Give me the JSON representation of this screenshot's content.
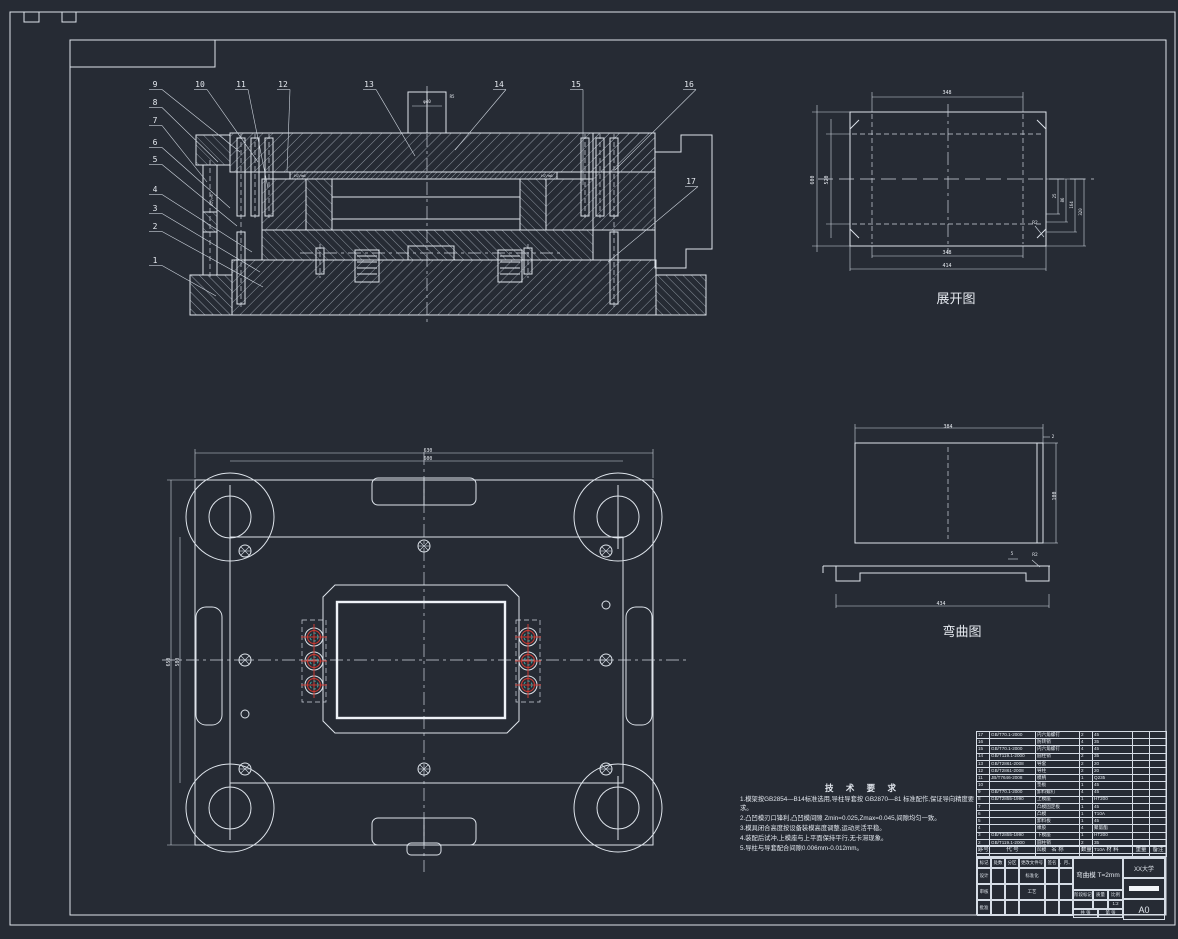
{
  "colors": {
    "bg": "#262b34",
    "line": "#dde3ea",
    "red": "#cc3a32",
    "teal": "#3f9f9f"
  },
  "views": {
    "develop": {
      "title": "展开图",
      "dims": [
        {
          "t": "348",
          "x": 947,
          "y": 94,
          "s": 5
        },
        {
          "t": "600",
          "x": 814,
          "y": 180,
          "r": -90,
          "s": 5
        },
        {
          "t": "520",
          "x": 828,
          "y": 180,
          "r": -90,
          "s": 5
        },
        {
          "t": "348",
          "x": 947,
          "y": 254,
          "s": 5
        },
        {
          "t": "414",
          "x": 947,
          "y": 267,
          "s": 5
        },
        {
          "t": "25",
          "x": 1056,
          "y": 196,
          "r": -90,
          "s": 4
        },
        {
          "t": "86",
          "x": 1064,
          "y": 200,
          "r": -90,
          "s": 4
        },
        {
          "t": "164",
          "x": 1073,
          "y": 205,
          "r": -90,
          "s": 4
        },
        {
          "t": "320",
          "x": 1082,
          "y": 212,
          "r": -90,
          "s": 4
        },
        {
          "t": "R2",
          "x": 1035,
          "y": 224,
          "s": 4.5
        }
      ]
    },
    "bend": {
      "title": "弯曲图",
      "dims": [
        {
          "t": "384",
          "x": 948,
          "y": 428,
          "s": 5
        },
        {
          "t": "2",
          "x": 1053,
          "y": 438,
          "s": 4.5
        },
        {
          "t": "100",
          "x": 1056,
          "y": 496,
          "r": -90,
          "s": 5
        },
        {
          "t": "R2",
          "x": 1035,
          "y": 556,
          "s": 4.5
        },
        {
          "t": "5",
          "x": 1012,
          "y": 555,
          "s": 4.5
        },
        {
          "t": "434",
          "x": 941,
          "y": 605,
          "s": 5
        }
      ]
    },
    "plan": {
      "dims": [
        {
          "t": "630",
          "x": 428,
          "y": 452,
          "s": 4.8
        },
        {
          "t": "600",
          "x": 428,
          "y": 460,
          "s": 4.8
        },
        {
          "t": "650",
          "x": 170,
          "y": 662,
          "r": -90,
          "s": 4.8
        },
        {
          "t": "580",
          "x": 179,
          "y": 662,
          "r": -90,
          "s": 4.8
        }
      ]
    },
    "section": {
      "labels": [
        {
          "t": "φ40",
          "x": 427,
          "y": 103,
          "s": 4.2
        },
        {
          "t": "R5",
          "x": 452,
          "y": 98,
          "s": 4
        },
        {
          "t": "H7/m6",
          "x": 300,
          "y": 177,
          "s": 3.8
        },
        {
          "t": "H7/m6",
          "x": 547,
          "y": 177,
          "s": 3.8
        },
        {
          "t": "H7/r6",
          "x": 213,
          "y": 200,
          "r": -90,
          "s": 3.8
        }
      ],
      "callouts": [
        {
          "n": "9",
          "x": 155,
          "y": 87,
          "tx": 240,
          "ty": 152
        },
        {
          "n": "8",
          "x": 155,
          "y": 105,
          "tx": 218,
          "ty": 162
        },
        {
          "n": "7",
          "x": 155,
          "y": 123,
          "tx": 207,
          "ty": 182
        },
        {
          "n": "6",
          "x": 155,
          "y": 145,
          "tx": 230,
          "ty": 208
        },
        {
          "n": "5",
          "x": 155,
          "y": 162,
          "tx": 237,
          "ty": 226
        },
        {
          "n": "4",
          "x": 155,
          "y": 192,
          "tx": 252,
          "ty": 252
        },
        {
          "n": "3",
          "x": 155,
          "y": 211,
          "tx": 260,
          "ty": 272
        },
        {
          "n": "2",
          "x": 155,
          "y": 229,
          "tx": 263,
          "ty": 287
        },
        {
          "n": "1",
          "x": 155,
          "y": 263,
          "tx": 216,
          "ty": 296
        },
        {
          "n": "10",
          "x": 200,
          "y": 87,
          "tx": 258,
          "ty": 162
        },
        {
          "n": "11",
          "x": 241,
          "y": 87,
          "tx": 268,
          "ty": 188
        },
        {
          "n": "12",
          "x": 283,
          "y": 87,
          "tx": 287,
          "ty": 172
        },
        {
          "n": "13",
          "x": 369,
          "y": 87,
          "tx": 415,
          "ty": 156
        },
        {
          "n": "14",
          "x": 499,
          "y": 87,
          "tx": 455,
          "ty": 150
        },
        {
          "n": "15",
          "x": 576,
          "y": 87,
          "tx": 583,
          "ty": 185
        },
        {
          "n": "16",
          "x": 689,
          "y": 87,
          "tx": 615,
          "ty": 170
        },
        {
          "n": "17",
          "x": 691,
          "y": 184,
          "tx": 608,
          "ty": 262
        }
      ]
    }
  },
  "notes": {
    "title": "技 术 要 求",
    "lines": [
      "1.模架按GB2854—B14标准选用,导柱导套按 GB2870—81 标准配作,保证导向精度要求。",
      "2.凸凹模刃口锋利,凸凹模间隙 Zmin=0.025,Zmax=0.045,间隙均匀一致。",
      "3.模具闭合高度按设备装模高度调整,运动灵活平稳。",
      "4.装配后试冲,上模座与上平面保持平行,无卡滞现象。",
      "5.导柱与导套配合间隙0.006mm-0.012mm。"
    ]
  },
  "bom": {
    "col_widths": [
      13,
      46,
      44,
      13,
      40,
      17,
      17
    ],
    "headers": [
      "序号",
      "代 号",
      "名 称",
      "数量",
      "材 料",
      "重量",
      "备注"
    ],
    "rows": [
      [
        "17",
        "GB/T70.1-2000",
        "内六角螺钉",
        "2",
        "45",
        "",
        ""
      ],
      [
        "16",
        "",
        "防转销",
        "4",
        "35",
        "",
        ""
      ],
      [
        "15",
        "GB/T70.1-2000",
        "内六角螺钉",
        "4",
        "45",
        "",
        ""
      ],
      [
        "14",
        "GB/T119.1-2000",
        "圆柱销",
        "2",
        "35",
        "",
        ""
      ],
      [
        "13",
        "GB/T2861-2008",
        "导套",
        "2",
        "20",
        "",
        ""
      ],
      [
        "12",
        "GB/T2861-2008",
        "导柱",
        "2",
        "20",
        "",
        ""
      ],
      [
        "11",
        "JB/T7646-2008",
        "模柄",
        "1",
        "Q235",
        "",
        ""
      ],
      [
        "10",
        "",
        "垫板",
        "1",
        "45",
        "",
        ""
      ],
      [
        "9",
        "GB/T70.1-2000",
        "卸料螺钉",
        "4",
        "45",
        "",
        ""
      ],
      [
        "8",
        "GB/T2855-1990",
        "上模座",
        "1",
        "HT200",
        "",
        ""
      ],
      [
        "7",
        "",
        "凸模固定板",
        "1",
        "45",
        "",
        ""
      ],
      [
        "6",
        "",
        "凸模",
        "1",
        "T10A",
        "",
        ""
      ],
      [
        "5",
        "",
        "卸料板",
        "1",
        "45",
        "",
        ""
      ],
      [
        "4",
        "",
        "橡胶",
        "4",
        "聚氨酯",
        "",
        ""
      ],
      [
        "3",
        "GB/T2855-1990",
        "下模座",
        "1",
        "HT200",
        "",
        ""
      ],
      [
        "2",
        "GB/T119.1-2000",
        "圆柱销",
        "2",
        "35",
        "",
        ""
      ],
      [
        "1",
        "",
        "凹模",
        "1",
        "T10A",
        "",
        ""
      ]
    ]
  },
  "titleblock": {
    "rev_table": {
      "widths": [
        14,
        14,
        14,
        26,
        14,
        14
      ],
      "heights": [
        10,
        16,
        16,
        16
      ],
      "rows": [
        [
          "标记",
          "处数",
          "分区",
          "更改文件号",
          "签名",
          "年、月、日"
        ],
        [
          "设计",
          "",
          "",
          "标准化",
          "",
          ""
        ],
        [
          "审核",
          "",
          "",
          "工艺",
          "",
          ""
        ],
        [
          "批准",
          "",
          "",
          "",
          "",
          ""
        ]
      ]
    },
    "name": "弯曲模 T=2mm",
    "stage_table": {
      "widths": [
        20,
        15,
        15
      ],
      "heights": [
        10,
        9
      ],
      "rows": [
        [
          "阶段标记",
          "质量",
          "比例"
        ],
        [
          "",
          "",
          "1:2"
        ]
      ]
    },
    "sheet_table": {
      "widths": [
        25,
        25
      ],
      "heights": [
        9
      ],
      "rows": [
        [
          "共 张",
          "第 张"
        ]
      ]
    },
    "org": "XX大学",
    "size": "A0"
  }
}
